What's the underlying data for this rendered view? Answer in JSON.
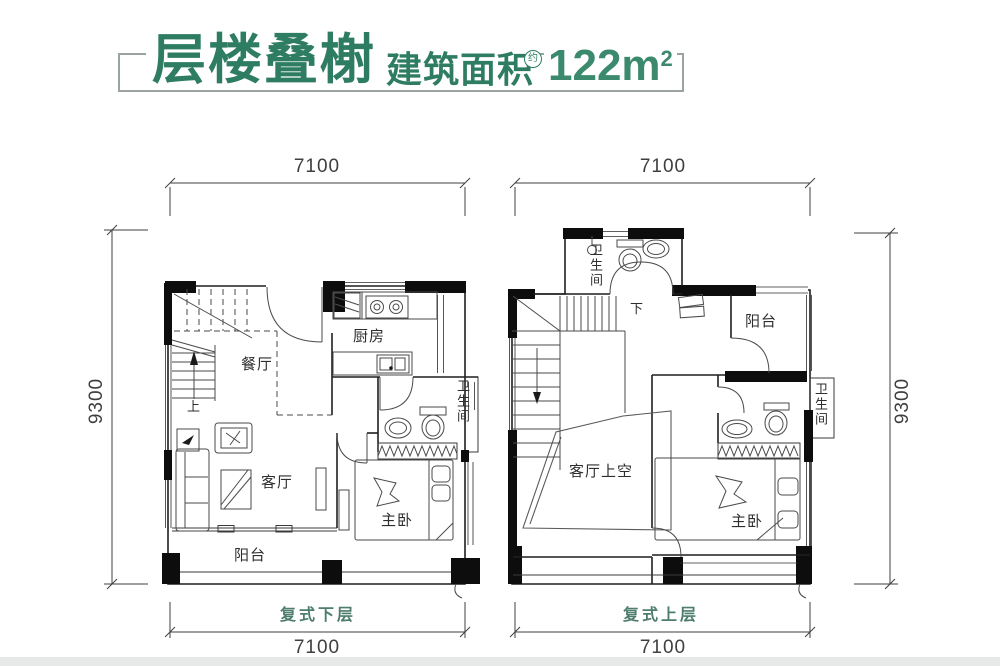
{
  "header": {
    "title": "层楼叠榭",
    "subtitle": "建筑面积",
    "approx": "约",
    "area": "122m",
    "area_exp": "2"
  },
  "plans": {
    "lower": {
      "name": "复式下层",
      "stair": "上",
      "dims": {
        "top": "7100",
        "bottom": "7100",
        "left": "9300"
      },
      "rooms": {
        "dining": "餐厅",
        "kitchen": "厨房",
        "bathroom": "卫生间",
        "living": "客厅",
        "master": "主卧",
        "balcony": "阳台"
      }
    },
    "upper": {
      "name": "复式上层",
      "stair": "下",
      "dims": {
        "top": "7100",
        "bottom": "7100",
        "right": "9300"
      },
      "rooms": {
        "bathroom_top": "卫生间",
        "balcony": "阳台",
        "bathroom_right": "卫生间",
        "living_void": "客厅上空",
        "master": "主卧"
      }
    }
  },
  "colors": {
    "title_green": "#2e7d63",
    "area_green": "#3c8a6e",
    "floor_label_green": "#4f7d6d",
    "wall_black": "#0d0d0d",
    "dim_gray": "#3f3f3f"
  }
}
